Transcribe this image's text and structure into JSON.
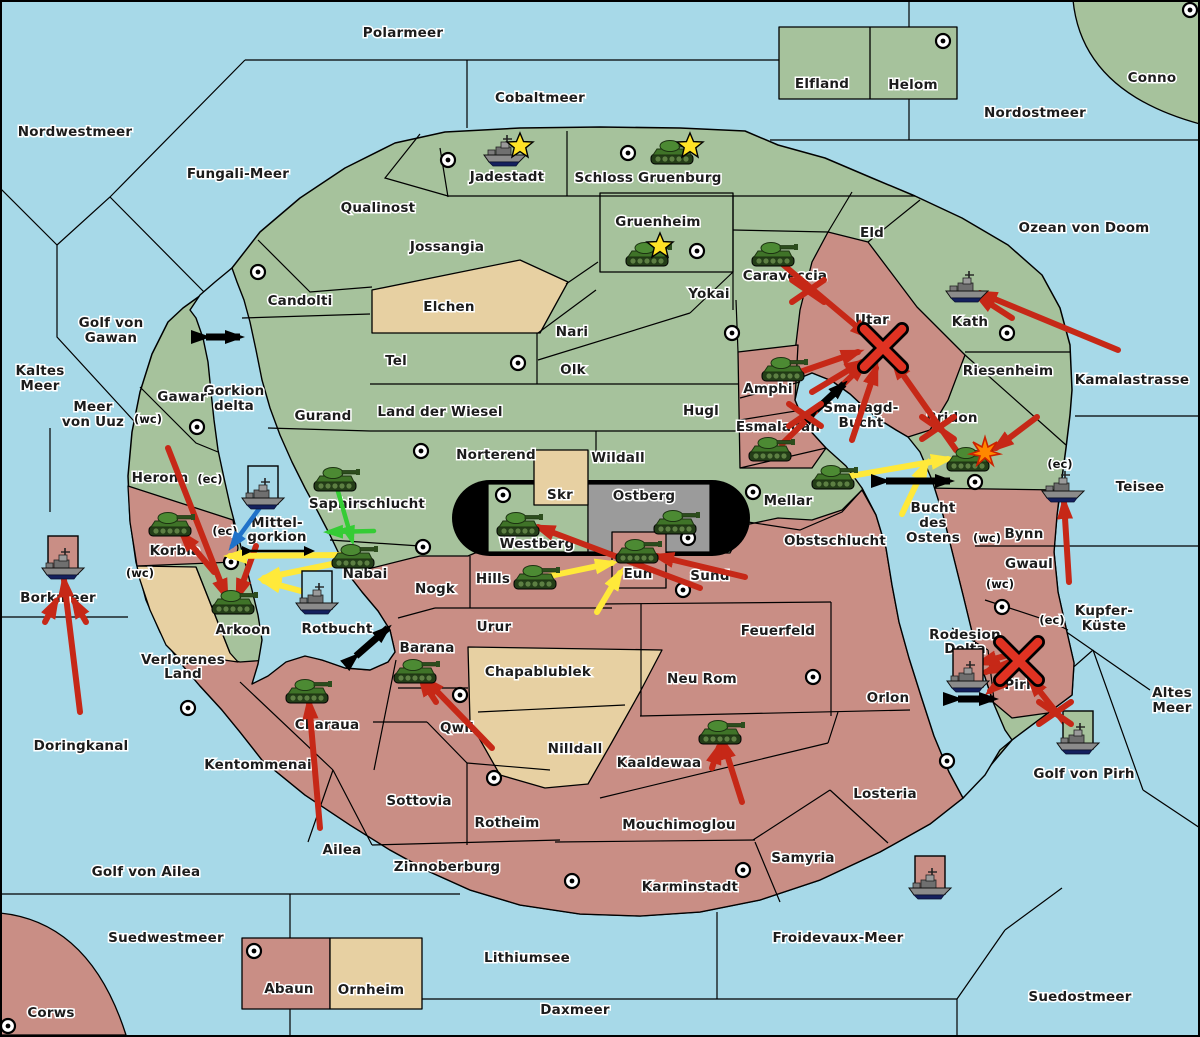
{
  "map": {
    "colors": {
      "sea": "#a7d9e8",
      "land_green": "#a6c29c",
      "land_pink": "#c98e85",
      "land_tan": "#e7d0a2",
      "land_gray": "#9b9b9b",
      "border": "#000000",
      "arrow_red": "#c62817",
      "arrow_yellow": "#ffe93a",
      "arrow_green": "#35cc35",
      "arrow_blue": "#1f72c9",
      "arrow_black": "#000000",
      "star": "#ffe226",
      "burst": "#ff8800"
    },
    "sea_labels": [
      {
        "text": "Polarmeer",
        "x": 403,
        "y": 37
      },
      {
        "text": "Cobaltmeer",
        "x": 540,
        "y": 102
      },
      {
        "text": "Nordostmeer",
        "x": 1035,
        "y": 117
      },
      {
        "text": "Nordwestmeer",
        "x": 75,
        "y": 136
      },
      {
        "text": "Fungali-Meer",
        "x": 238,
        "y": 178
      },
      {
        "text": "Ozean von Doom",
        "x": 1084,
        "y": 232
      },
      {
        "lines": [
          "Kaltes",
          "Meer"
        ],
        "x": 40,
        "y": 375
      },
      {
        "lines": [
          "Golf von",
          "Gawan"
        ],
        "x": 111,
        "y": 327
      },
      {
        "lines": [
          "Meer",
          "von Uuz"
        ],
        "x": 93,
        "y": 411
      },
      {
        "lines": [
          "Gorkion",
          "delta"
        ],
        "x": 234,
        "y": 395
      },
      {
        "text": "Kamalastrasse",
        "x": 1132,
        "y": 384
      },
      {
        "text": "Teisee",
        "x": 1140,
        "y": 491
      },
      {
        "text": "Borkmeer",
        "x": 58,
        "y": 602
      },
      {
        "lines": [
          "Kupfer-",
          "Küste"
        ],
        "x": 1104,
        "y": 615
      },
      {
        "lines": [
          "Altes",
          "Meer"
        ],
        "x": 1172,
        "y": 697
      },
      {
        "text": "Doringkanal",
        "x": 81,
        "y": 750
      },
      {
        "text": "Golf von Ailea",
        "x": 146,
        "y": 876
      },
      {
        "text": "Suedwestmeer",
        "x": 166,
        "y": 942
      },
      {
        "text": "Corws",
        "x": 51,
        "y": 1017
      },
      {
        "text": "Lithiumsee",
        "x": 527,
        "y": 962
      },
      {
        "text": "Daxmeer",
        "x": 575,
        "y": 1014
      },
      {
        "text": "Froidevaux-Meer",
        "x": 838,
        "y": 942
      },
      {
        "text": "Suedostmeer",
        "x": 1080,
        "y": 1001
      },
      {
        "lines": [
          "Smaragd-",
          "Bucht"
        ],
        "x": 861,
        "y": 412
      },
      {
        "lines": [
          "Bucht",
          "des",
          "Ostens"
        ],
        "x": 933,
        "y": 512
      },
      {
        "text": "Rotbucht",
        "x": 337,
        "y": 633
      },
      {
        "text": "Golf von Pirh",
        "x": 1084,
        "y": 778
      }
    ],
    "land_labels": [
      {
        "text": "Elfland",
        "x": 822,
        "y": 88
      },
      {
        "text": "Helom",
        "x": 913,
        "y": 89
      },
      {
        "text": "Conno",
        "x": 1152,
        "y": 82
      },
      {
        "text": "Jadestadt",
        "x": 507,
        "y": 181
      },
      {
        "text": "Schloss Gruenburg",
        "x": 648,
        "y": 182
      },
      {
        "text": "Qualinost",
        "x": 378,
        "y": 212
      },
      {
        "text": "Jossangia",
        "x": 447,
        "y": 251
      },
      {
        "text": "Gruenheim",
        "x": 658,
        "y": 226
      },
      {
        "text": "Caraveccia",
        "x": 785,
        "y": 280
      },
      {
        "text": "Eld",
        "x": 872,
        "y": 237
      },
      {
        "text": "Kath",
        "x": 970,
        "y": 326
      },
      {
        "text": "Candolti",
        "x": 300,
        "y": 305
      },
      {
        "text": "Elchen",
        "x": 449,
        "y": 311
      },
      {
        "text": "Yokai",
        "x": 709,
        "y": 298
      },
      {
        "text": "Nari",
        "x": 572,
        "y": 336
      },
      {
        "text": "Olk",
        "x": 573,
        "y": 374
      },
      {
        "text": "Tel",
        "x": 396,
        "y": 365
      },
      {
        "text": "Utar",
        "x": 872,
        "y": 324
      },
      {
        "text": "Riesenheim",
        "x": 1008,
        "y": 375
      },
      {
        "text": "Gurand",
        "x": 323,
        "y": 420
      },
      {
        "text": "Land der Wiesel",
        "x": 440,
        "y": 416
      },
      {
        "text": "Hugl",
        "x": 701,
        "y": 415
      },
      {
        "text": "Gawar",
        "x": 182,
        "y": 401
      },
      {
        "text": "Amphi",
        "x": 768,
        "y": 393
      },
      {
        "text": "Esmaladan",
        "x": 778,
        "y": 431
      },
      {
        "text": "Bridon",
        "x": 952,
        "y": 422
      },
      {
        "text": "Norterend",
        "x": 496,
        "y": 459
      },
      {
        "text": "Wildall",
        "x": 618,
        "y": 462
      },
      {
        "text": "Skr",
        "x": 560,
        "y": 499
      },
      {
        "text": "Ostberg",
        "x": 644,
        "y": 500
      },
      {
        "text": "Westberg",
        "x": 537,
        "y": 548
      },
      {
        "text": "Mellar",
        "x": 788,
        "y": 505
      },
      {
        "text": "Heronn",
        "x": 160,
        "y": 482
      },
      {
        "text": "Saphirschlucht",
        "x": 367,
        "y": 508
      },
      {
        "lines": [
          "Mittel-",
          "gorkion"
        ],
        "x": 277,
        "y": 527
      },
      {
        "text": "Korbia",
        "x": 175,
        "y": 555
      },
      {
        "text": "Nabai",
        "x": 365,
        "y": 578
      },
      {
        "text": "Hills",
        "x": 493,
        "y": 583
      },
      {
        "text": "Eun",
        "x": 638,
        "y": 578
      },
      {
        "text": "Sund",
        "x": 710,
        "y": 580
      },
      {
        "text": "Obstschlucht",
        "x": 835,
        "y": 545
      },
      {
        "text": "Bynn",
        "x": 1024,
        "y": 538
      },
      {
        "text": "Gwaul",
        "x": 1029,
        "y": 568
      },
      {
        "text": "Arkoon",
        "x": 243,
        "y": 634
      },
      {
        "lines": [
          "Verlorenes",
          "Land"
        ],
        "x": 183,
        "y": 664
      },
      {
        "text": "Nogk",
        "x": 435,
        "y": 593
      },
      {
        "text": "Urur",
        "x": 494,
        "y": 631
      },
      {
        "text": "Feuerfeld",
        "x": 778,
        "y": 635
      },
      {
        "text": "Barana",
        "x": 427,
        "y": 652
      },
      {
        "text": "Chapablublek",
        "x": 538,
        "y": 676
      },
      {
        "text": "Neu Rom",
        "x": 702,
        "y": 683
      },
      {
        "lines": [
          "Rodesion",
          "Delta"
        ],
        "x": 965,
        "y": 639
      },
      {
        "text": "Pirh",
        "x": 1020,
        "y": 689
      },
      {
        "text": "Orlon",
        "x": 888,
        "y": 702
      },
      {
        "text": "Charaua",
        "x": 327,
        "y": 729
      },
      {
        "text": "Qwil",
        "x": 457,
        "y": 732
      },
      {
        "text": "Nilldall",
        "x": 575,
        "y": 753
      },
      {
        "text": "Kaaldewaa",
        "x": 659,
        "y": 767
      },
      {
        "text": "Kentommenai",
        "x": 258,
        "y": 769
      },
      {
        "text": "Sottovia",
        "x": 419,
        "y": 805
      },
      {
        "text": "Rotheim",
        "x": 507,
        "y": 827
      },
      {
        "text": "Mouchimoglou",
        "x": 679,
        "y": 829
      },
      {
        "text": "Losteria",
        "x": 885,
        "y": 798
      },
      {
        "text": "Ailea",
        "x": 342,
        "y": 854
      },
      {
        "text": "Zinnoberburg",
        "x": 447,
        "y": 871
      },
      {
        "text": "Samyria",
        "x": 803,
        "y": 862
      },
      {
        "text": "Karminstadt",
        "x": 690,
        "y": 891
      },
      {
        "text": "Abaun",
        "x": 289,
        "y": 993
      },
      {
        "text": "Ornheim",
        "x": 371,
        "y": 994
      }
    ],
    "coast_tags": [
      {
        "text": "(wc)",
        "x": 148,
        "y": 423
      },
      {
        "text": "(ec)",
        "x": 210,
        "y": 483
      },
      {
        "text": "(ec)",
        "x": 225,
        "y": 535
      },
      {
        "text": "(wc)",
        "x": 140,
        "y": 577
      },
      {
        "text": "(wc)",
        "x": 987,
        "y": 542
      },
      {
        "text": "(wc)",
        "x": 1000,
        "y": 588
      },
      {
        "text": "(ec)",
        "x": 1052,
        "y": 624
      },
      {
        "text": "(ec)",
        "x": 1060,
        "y": 468
      }
    ],
    "supply_centers": [
      [
        448,
        160
      ],
      [
        628,
        153
      ],
      [
        943,
        41
      ],
      [
        1190,
        10
      ],
      [
        697,
        251
      ],
      [
        732,
        333
      ],
      [
        258,
        272
      ],
      [
        197,
        427
      ],
      [
        518,
        363
      ],
      [
        421,
        451
      ],
      [
        503,
        495
      ],
      [
        688,
        538
      ],
      [
        753,
        492
      ],
      [
        1007,
        333
      ],
      [
        423,
        547
      ],
      [
        231,
        562
      ],
      [
        188,
        708
      ],
      [
        683,
        590
      ],
      [
        813,
        677
      ],
      [
        460,
        695
      ],
      [
        494,
        778
      ],
      [
        743,
        870
      ],
      [
        572,
        881
      ],
      [
        947,
        761
      ],
      [
        1002,
        607
      ],
      [
        254,
        951
      ],
      [
        8,
        1026
      ],
      [
        975,
        482
      ]
    ],
    "units": [
      {
        "type": "ship",
        "x": 505,
        "y": 152
      },
      {
        "type": "tank",
        "x": 672,
        "y": 153
      },
      {
        "type": "tank",
        "x": 647,
        "y": 255
      },
      {
        "type": "tank",
        "x": 773,
        "y": 255
      },
      {
        "type": "ship",
        "x": 967,
        "y": 288
      },
      {
        "type": "tank",
        "x": 783,
        "y": 370
      },
      {
        "type": "tank",
        "x": 770,
        "y": 450
      },
      {
        "type": "tank",
        "x": 833,
        "y": 478
      },
      {
        "type": "tank",
        "x": 968,
        "y": 460
      },
      {
        "type": "ship",
        "x": 1063,
        "y": 488
      },
      {
        "type": "tank",
        "x": 675,
        "y": 523
      },
      {
        "type": "tank",
        "x": 518,
        "y": 525
      },
      {
        "type": "tank",
        "x": 637,
        "y": 552
      },
      {
        "type": "tank",
        "x": 535,
        "y": 578
      },
      {
        "type": "tank",
        "x": 335,
        "y": 480
      },
      {
        "type": "ship",
        "x": 263,
        "y": 495,
        "box": "sea"
      },
      {
        "type": "tank",
        "x": 170,
        "y": 525
      },
      {
        "type": "tank",
        "x": 233,
        "y": 603
      },
      {
        "type": "tank",
        "x": 353,
        "y": 557
      },
      {
        "type": "ship",
        "x": 317,
        "y": 600,
        "box": "sea"
      },
      {
        "type": "ship",
        "x": 63,
        "y": 565,
        "box": "pink"
      },
      {
        "type": "tank",
        "x": 415,
        "y": 672
      },
      {
        "type": "tank",
        "x": 307,
        "y": 692
      },
      {
        "type": "tank",
        "x": 720,
        "y": 733
      },
      {
        "type": "ship",
        "x": 968,
        "y": 678,
        "box": "pink"
      },
      {
        "type": "ship",
        "x": 1078,
        "y": 740,
        "box": "green"
      },
      {
        "type": "ship",
        "x": 930,
        "y": 885,
        "box": "pink"
      }
    ],
    "arrows": [
      {
        "c": "red",
        "x1": 780,
        "y1": 262,
        "x2": 868,
        "y2": 336
      },
      {
        "c": "red",
        "x1": 800,
        "y1": 372,
        "x2": 858,
        "y2": 352
      },
      {
        "c": "red",
        "x1": 812,
        "y1": 392,
        "x2": 862,
        "y2": 362
      },
      {
        "c": "red",
        "x1": 782,
        "y1": 444,
        "x2": 864,
        "y2": 364
      },
      {
        "c": "red",
        "x1": 956,
        "y1": 450,
        "x2": 894,
        "y2": 362
      },
      {
        "c": "red",
        "x1": 852,
        "y1": 440,
        "x2": 876,
        "y2": 368
      },
      {
        "c": "red",
        "x1": 1118,
        "y1": 350,
        "x2": 980,
        "y2": 293
      },
      {
        "c": "red",
        "x1": 1012,
        "y1": 318,
        "x2": 978,
        "y2": 296
      },
      {
        "c": "red",
        "x1": 1037,
        "y1": 417,
        "x2": 996,
        "y2": 448
      },
      {
        "c": "red",
        "x1": 1069,
        "y1": 582,
        "x2": 1064,
        "y2": 502
      },
      {
        "c": "red",
        "x1": 1014,
        "y1": 660,
        "x2": 986,
        "y2": 672
      },
      {
        "c": "red",
        "x1": 1018,
        "y1": 668,
        "x2": 990,
        "y2": 691
      },
      {
        "c": "red",
        "x1": 1008,
        "y1": 655,
        "x2": 980,
        "y2": 663
      },
      {
        "c": "red",
        "x1": 1072,
        "y1": 732,
        "x2": 1030,
        "y2": 679
      },
      {
        "c": "red",
        "x1": 80,
        "y1": 712,
        "x2": 64,
        "y2": 580
      },
      {
        "c": "red",
        "x1": 45,
        "y1": 622,
        "x2": 56,
        "y2": 601
      },
      {
        "c": "red",
        "x1": 86,
        "y1": 622,
        "x2": 74,
        "y2": 601
      },
      {
        "c": "red",
        "x1": 168,
        "y1": 448,
        "x2": 226,
        "y2": 596
      },
      {
        "c": "red",
        "x1": 256,
        "y1": 546,
        "x2": 238,
        "y2": 596
      },
      {
        "c": "red",
        "x1": 214,
        "y1": 572,
        "x2": 182,
        "y2": 534
      },
      {
        "c": "red",
        "x1": 320,
        "y1": 828,
        "x2": 309,
        "y2": 702
      },
      {
        "c": "red",
        "x1": 742,
        "y1": 802,
        "x2": 723,
        "y2": 742
      },
      {
        "c": "red",
        "x1": 712,
        "y1": 768,
        "x2": 719,
        "y2": 747
      },
      {
        "c": "red",
        "x1": 492,
        "y1": 748,
        "x2": 426,
        "y2": 680
      },
      {
        "c": "red",
        "x1": 436,
        "y1": 702,
        "x2": 421,
        "y2": 679
      },
      {
        "c": "red",
        "x1": 745,
        "y1": 577,
        "x2": 657,
        "y2": 556
      },
      {
        "c": "red",
        "x1": 700,
        "y1": 588,
        "x2": 538,
        "y2": 527
      },
      {
        "c": "yellow",
        "x1": 845,
        "y1": 477,
        "x2": 948,
        "y2": 459
      },
      {
        "c": "yellow",
        "x1": 902,
        "y1": 514,
        "x2": 926,
        "y2": 464
      },
      {
        "c": "yellow",
        "x1": 545,
        "y1": 577,
        "x2": 612,
        "y2": 563
      },
      {
        "c": "yellow",
        "x1": 597,
        "y1": 612,
        "x2": 620,
        "y2": 573
      },
      {
        "c": "yellow",
        "x1": 344,
        "y1": 555,
        "x2": 230,
        "y2": 556
      },
      {
        "c": "yellow",
        "x1": 342,
        "y1": 562,
        "x2": 264,
        "y2": 578
      },
      {
        "c": "yellow",
        "x1": 312,
        "y1": 594,
        "x2": 264,
        "y2": 581
      },
      {
        "c": "green",
        "x1": 337,
        "y1": 488,
        "x2": 352,
        "y2": 540
      },
      {
        "c": "green",
        "x1": 374,
        "y1": 531,
        "x2": 329,
        "y2": 532
      },
      {
        "c": "blue",
        "x1": 261,
        "y1": 506,
        "x2": 232,
        "y2": 546
      }
    ],
    "double_arrows": [
      {
        "x1": 206,
        "y1": 337,
        "x2": 240,
        "y2": 337
      },
      {
        "x1": 886,
        "y1": 481,
        "x2": 950,
        "y2": 481
      },
      {
        "x1": 958,
        "y1": 699,
        "x2": 994,
        "y2": 699
      },
      {
        "x1": 356,
        "y1": 656,
        "x2": 388,
        "y2": 628
      },
      {
        "x1": 816,
        "y1": 410,
        "x2": 844,
        "y2": 384
      },
      {
        "x1": 250,
        "y1": 551,
        "x2": 312,
        "y2": 551,
        "thin": true
      }
    ],
    "markers": [
      {
        "type": "star",
        "x": 520,
        "y": 146
      },
      {
        "type": "star",
        "x": 690,
        "y": 146
      },
      {
        "type": "star",
        "x": 660,
        "y": 246
      },
      {
        "type": "burst",
        "x": 985,
        "y": 452
      },
      {
        "type": "big-x",
        "x": 883,
        "y": 348
      },
      {
        "type": "big-x",
        "x": 1019,
        "y": 661
      },
      {
        "type": "cut-x",
        "x": 808,
        "y": 291
      },
      {
        "type": "cut-x",
        "x": 805,
        "y": 415
      },
      {
        "type": "cut-x",
        "x": 938,
        "y": 428
      },
      {
        "type": "cut-x",
        "x": 1055,
        "y": 713
      }
    ]
  }
}
